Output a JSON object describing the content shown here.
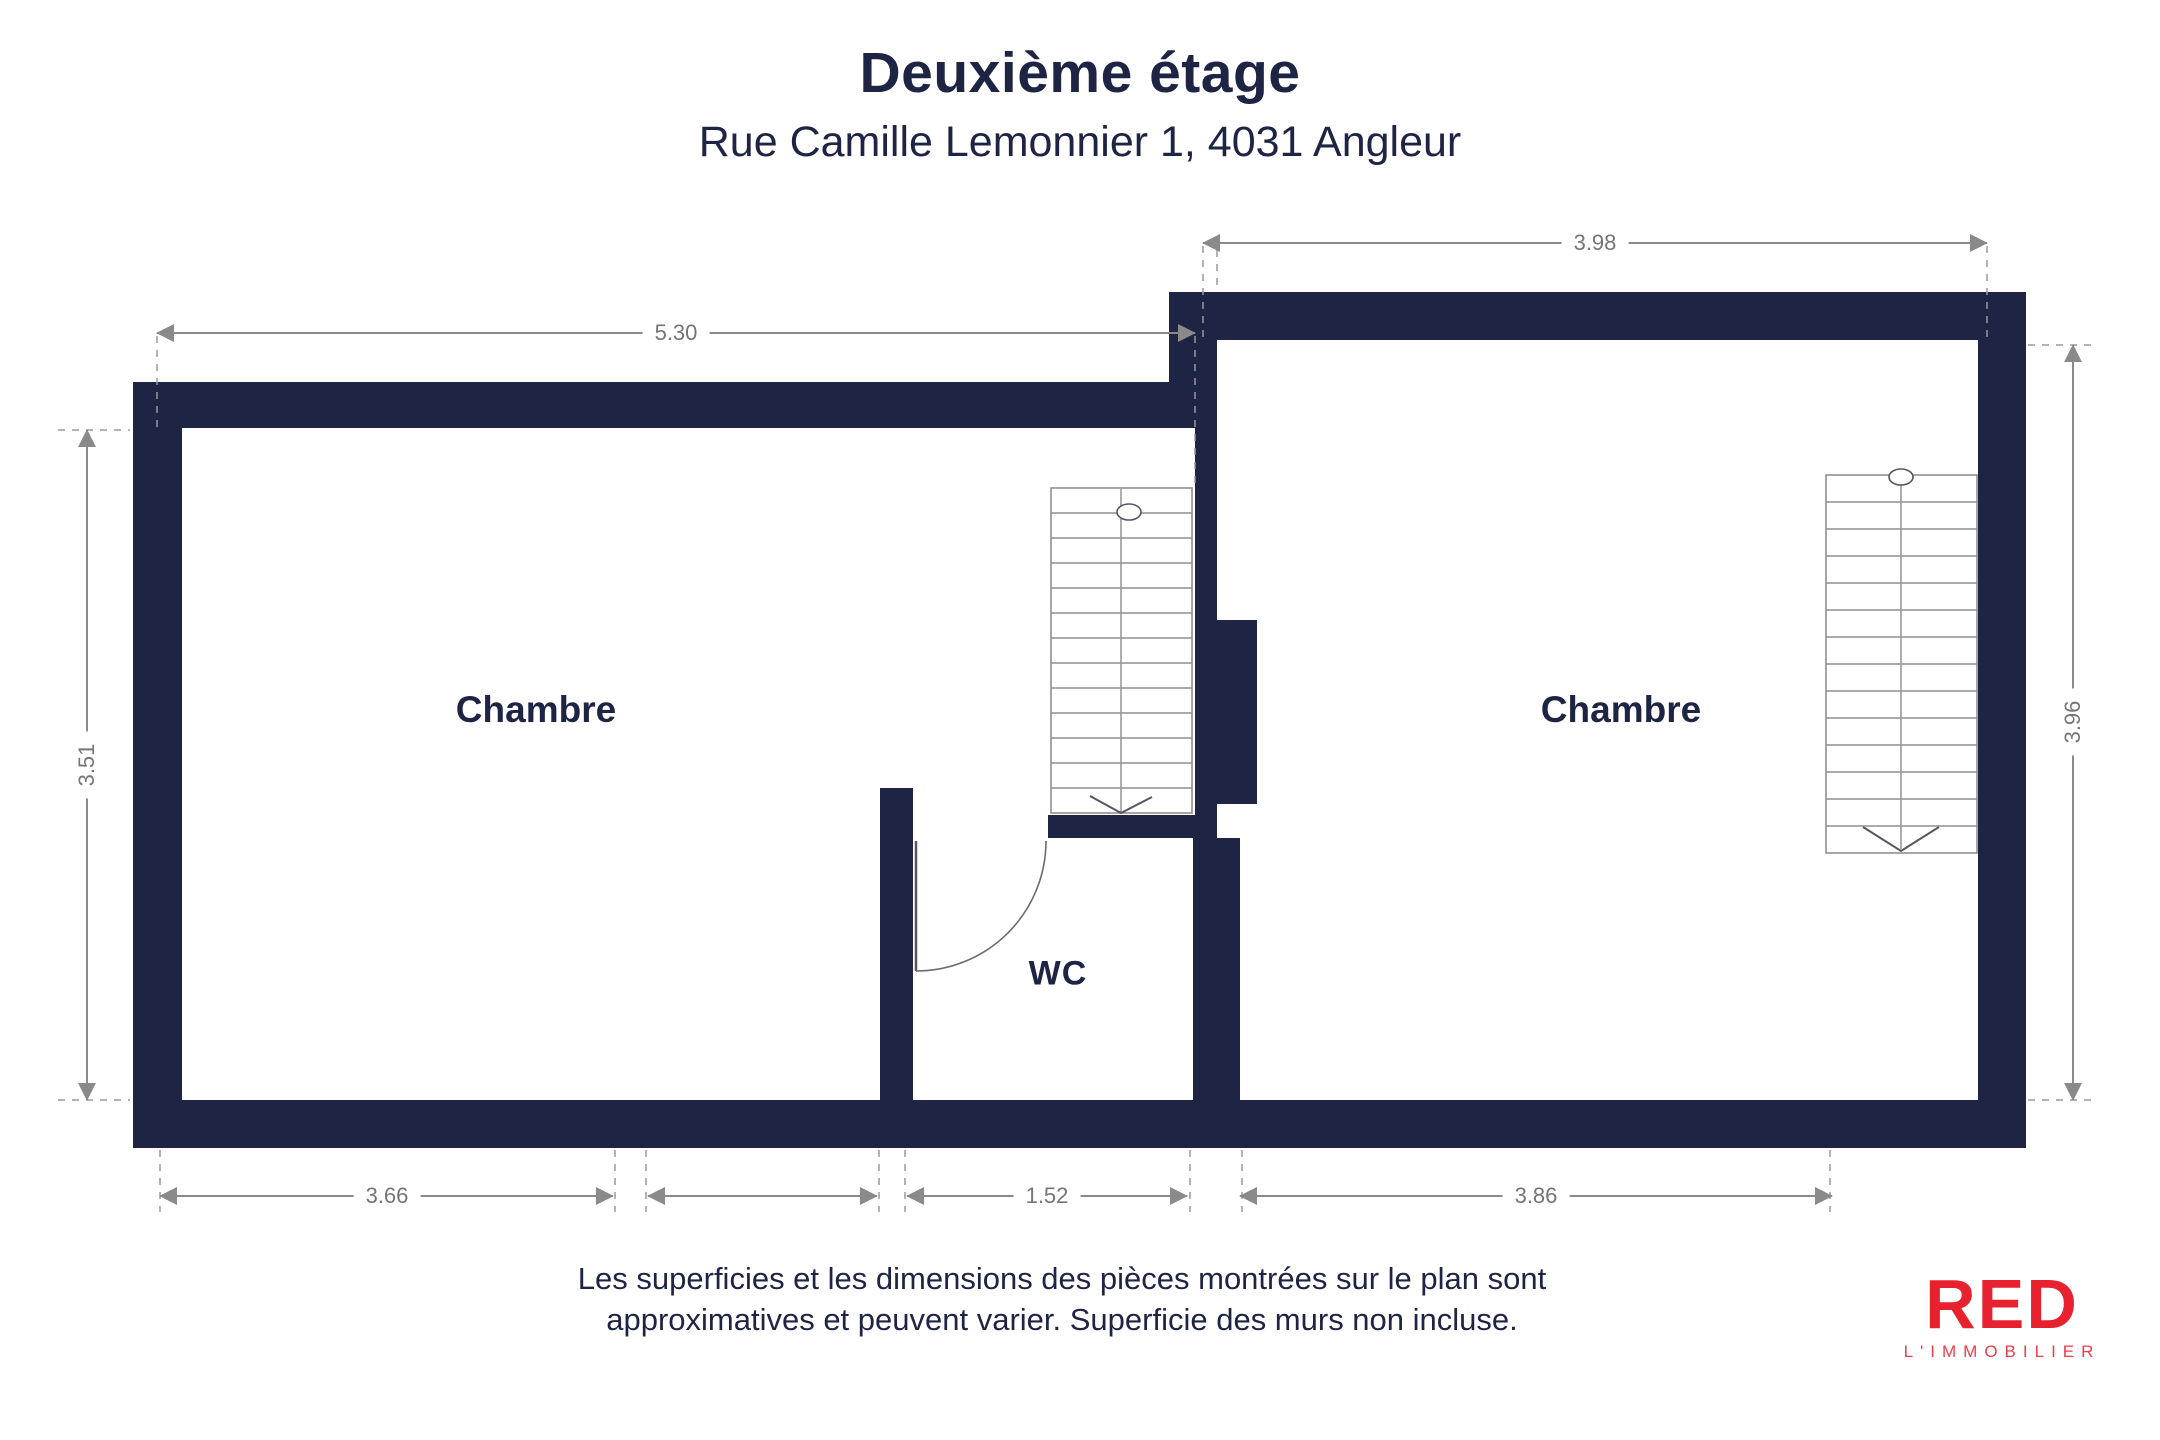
{
  "header": {
    "title": "Deuxième étage",
    "subtitle": "Rue Camille Lemonnier 1, 4031 Angleur"
  },
  "floorplan": {
    "rooms": [
      {
        "label": "Chambre"
      },
      {
        "label": "Chambre"
      },
      {
        "label": "WC"
      }
    ],
    "dimensions": {
      "top_left": "5.30",
      "top_right": "3.98",
      "left": "3.51",
      "right": "3.96",
      "bottom_left": "3.66",
      "bottom_middle": "1.52",
      "bottom_right": "3.86"
    }
  },
  "footer": {
    "disclaimer_line1": "Les superficies et les dimensions des pièces montrées sur le plan sont",
    "disclaimer_line2": "approximatives et peuvent varier. Superficie des murs non incluse.",
    "logo": {
      "brand": "RED",
      "tagline": "L'IMMOBILIER"
    }
  },
  "colors": {
    "wall": "#1d2444",
    "dimension_line": "#8a8a8a",
    "dimension_text": "#757575",
    "logo_red": "#e7212e"
  }
}
